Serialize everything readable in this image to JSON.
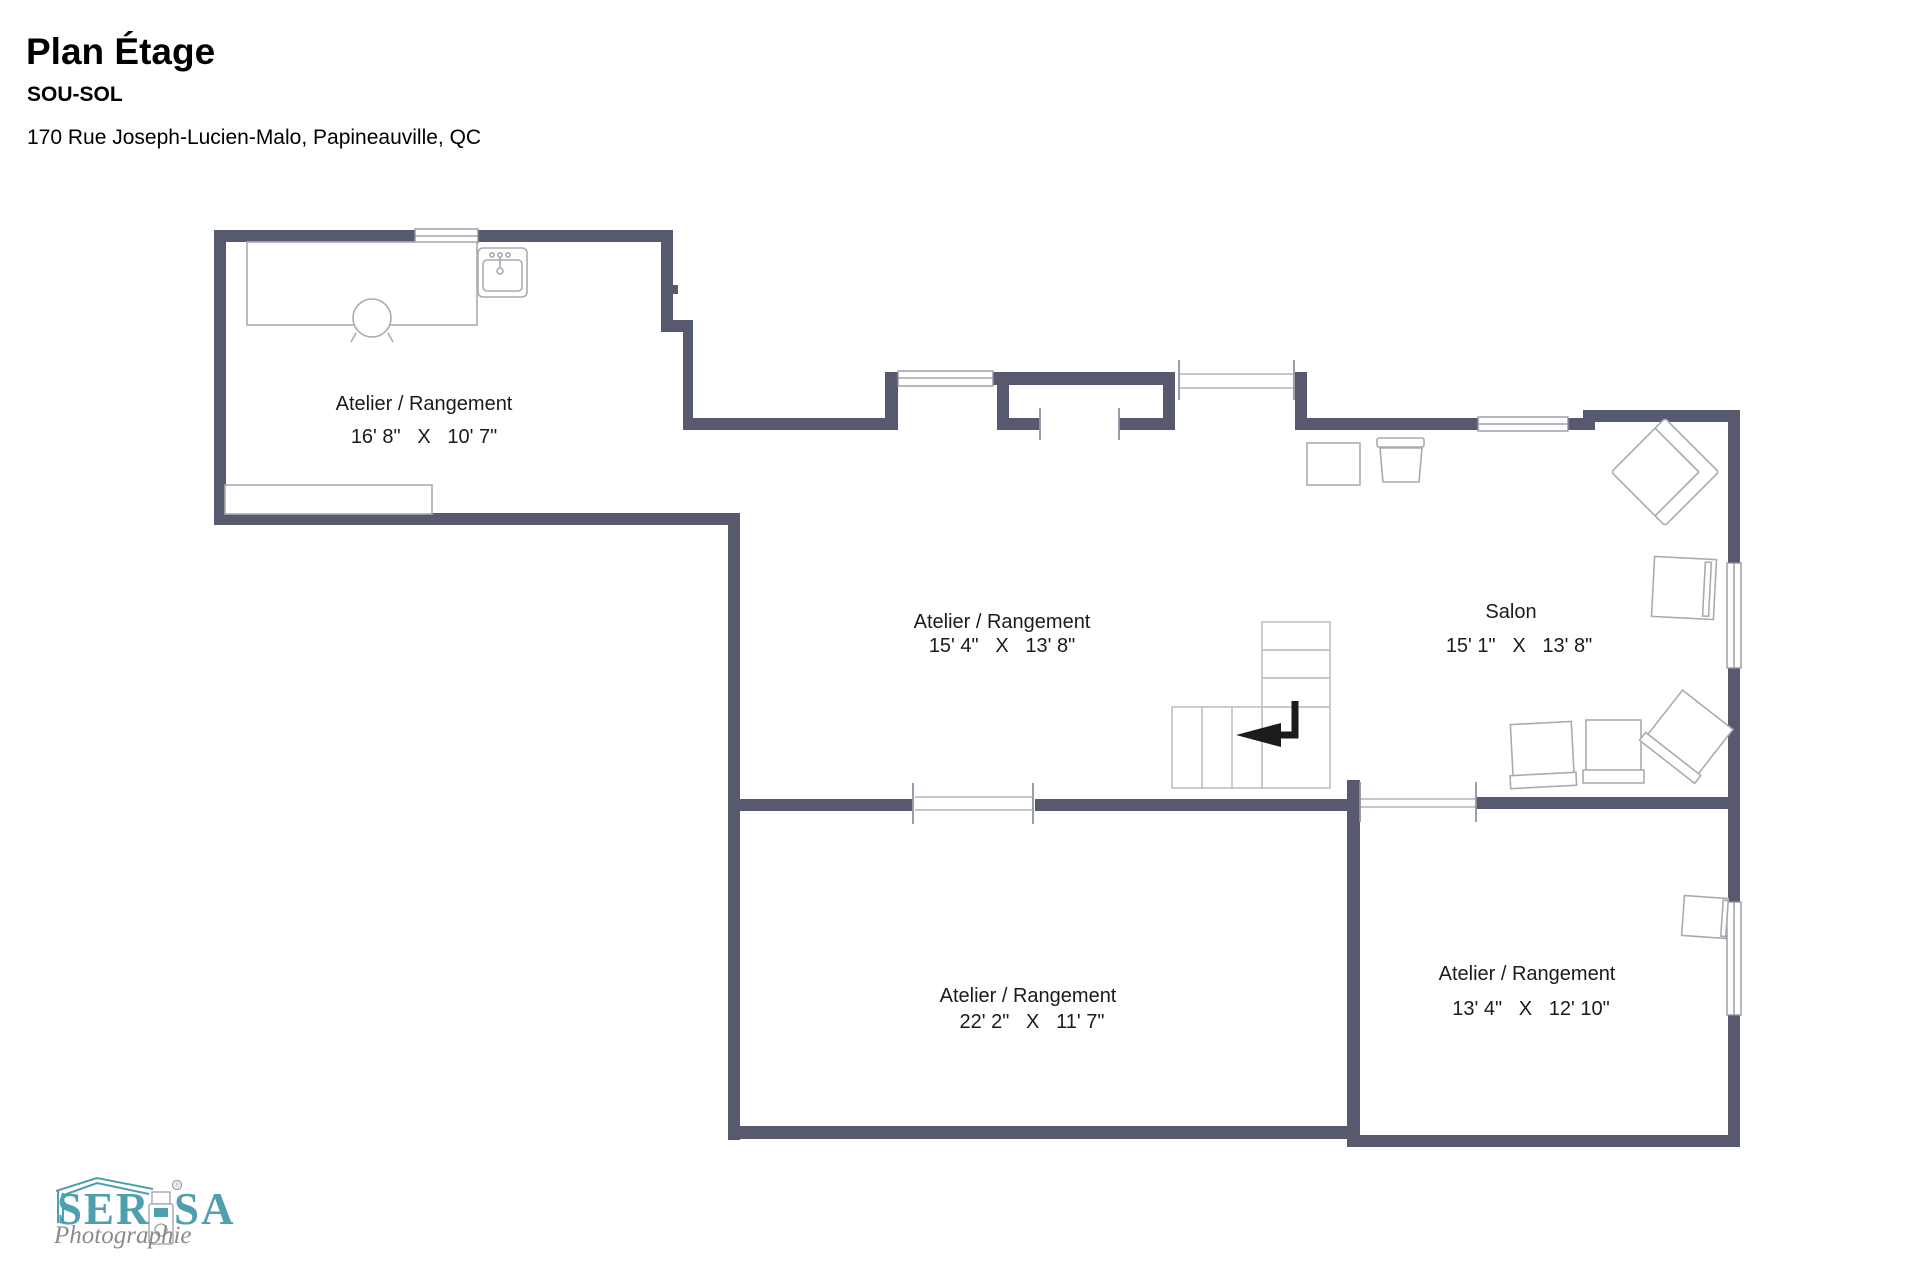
{
  "header": {
    "title": "Plan Étage",
    "subtitle": "SOU-SOL",
    "address": "170 Rue Joseph-Lucien-Malo, Papineauville, QC"
  },
  "rooms": {
    "atelier_nw": {
      "label": "Atelier / Rangement",
      "dims": "16' 8\"   X   10' 7\""
    },
    "atelier_center": {
      "label": "Atelier / Rangement",
      "dims": "15' 4\"   X   13' 8\""
    },
    "salon": {
      "label": "Salon",
      "dims": "15' 1\"   X   13' 8\""
    },
    "atelier_south": {
      "label": "Atelier / Rangement",
      "dims": "22' 2\"   X   11' 7\""
    },
    "atelier_se": {
      "label": "Atelier / Rangement",
      "dims": "13' 4\"   X   12' 10\""
    }
  },
  "logo": {
    "brand_left": "SER",
    "brand_right": "SA",
    "tagline": "Photographie",
    "registered": "®"
  },
  "colors": {
    "wall": "#575a6e",
    "furniture_outline": "#a8abb2",
    "stair_outline": "#b5b7bd",
    "window_frame": "#8e929e",
    "arrow": "#1c1c1c",
    "logo_teal": "#4f9fae",
    "logo_gray": "#8b8b8b"
  }
}
